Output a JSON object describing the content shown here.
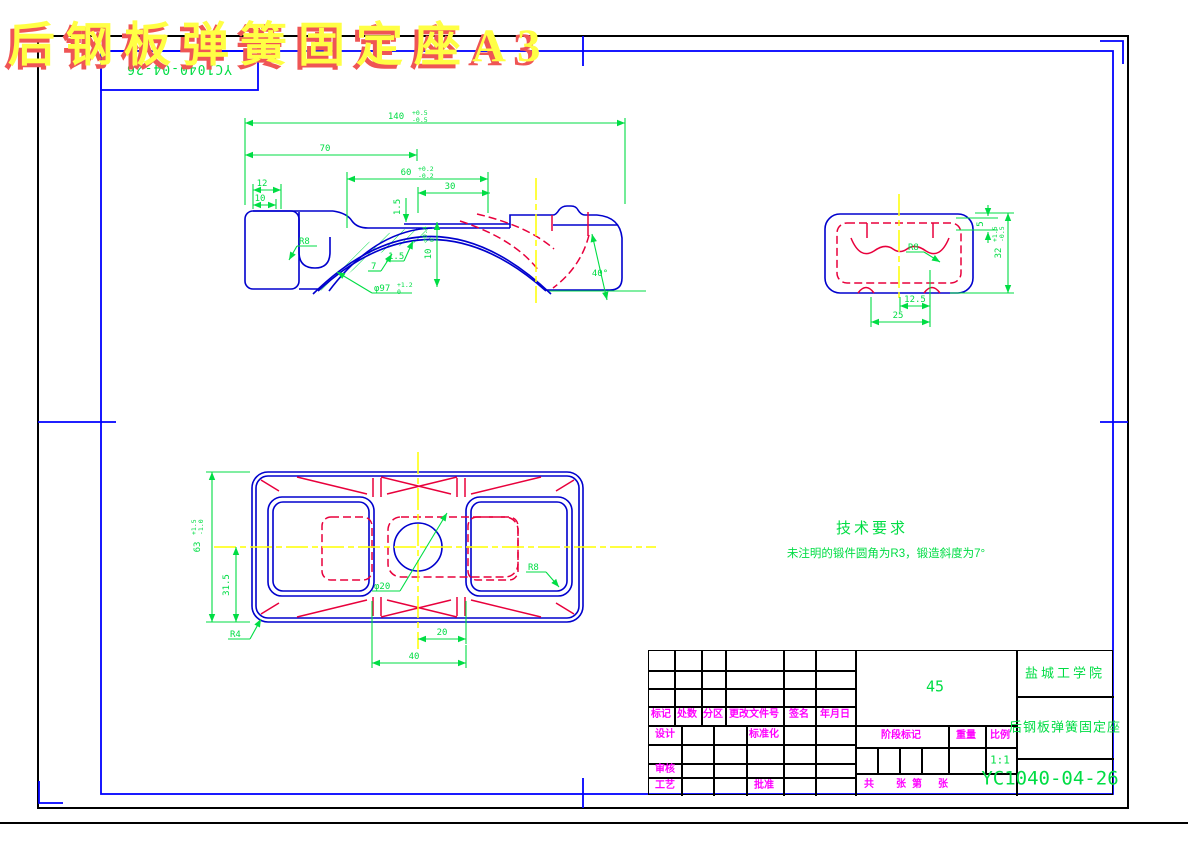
{
  "title": {
    "text": "后钢板弹簧固定座A3"
  },
  "corner_box": {
    "part_no": "YC1040-04-26"
  },
  "tech": {
    "heading": "技术要求",
    "note": "未注明的锻件圆角为R3，锻造斜度为7°"
  },
  "front_view": {
    "dims": {
      "len140": "140",
      "len140_tu": "+0.5",
      "len140_td": "-0.5",
      "len70": "70",
      "len60": "60",
      "len60_tu": "+0.2",
      "len60_td": "-0.2",
      "len30": "30",
      "len12": "12",
      "len10": "10",
      "step15": "1.5",
      "rad8": "R8",
      "wall7": "7",
      "gap15": "1.5",
      "dia97": "φ97",
      "dia97_tu": "+1.2",
      "dia97_td": "0",
      "dep10": "10",
      "dep10_tu": "+0.4",
      "dep10_td": "0",
      "ang40": "40°"
    }
  },
  "side_view": {
    "dims": {
      "len5": "5",
      "len32": "32",
      "len32_tu": "+1.5",
      "len32_td": "-0.5",
      "rad8": "R8",
      "len125": "12.5",
      "len25": "25"
    }
  },
  "plan_view": {
    "dims": {
      "len63": "63",
      "len63_tu": "+1.5",
      "len63_td": "-1.0",
      "len315": "31.5",
      "rad4": "R4",
      "dia20": "φ20",
      "len20": "20",
      "len40": "40",
      "rad8": "R8"
    }
  },
  "title_block": {
    "material": "45",
    "scale": "1:1",
    "school": "盐城工学院",
    "part_name": "后钢板弹簧固定座",
    "drawing_no": "YC1040-04-26",
    "labels": {
      "mark": "标记",
      "count": "处数",
      "zone": "分区",
      "doc_no": "更改文件号",
      "sign": "签名",
      "date": "年月日",
      "design": "设计",
      "standardize": "标准化",
      "check": "审核",
      "process": "工艺",
      "approve": "批准",
      "stage_mark": "阶段标记",
      "weight": "重量",
      "scale_label": "比例",
      "sheet_gong": "共",
      "sheet_zhang1": "张",
      "sheet_di": "第",
      "sheet_zhang2": "张"
    }
  },
  "colors": {
    "frame_blue": "#0000ff",
    "outline_blue": "#0000cd",
    "dimension_green": "#00dd44",
    "hidden_red": "#e8003c",
    "centerline_yellow": "#ffff00",
    "label_magenta": "#ff00ff",
    "title_yellow": "#ffff44",
    "title_shadow_red": "#ef5555"
  }
}
